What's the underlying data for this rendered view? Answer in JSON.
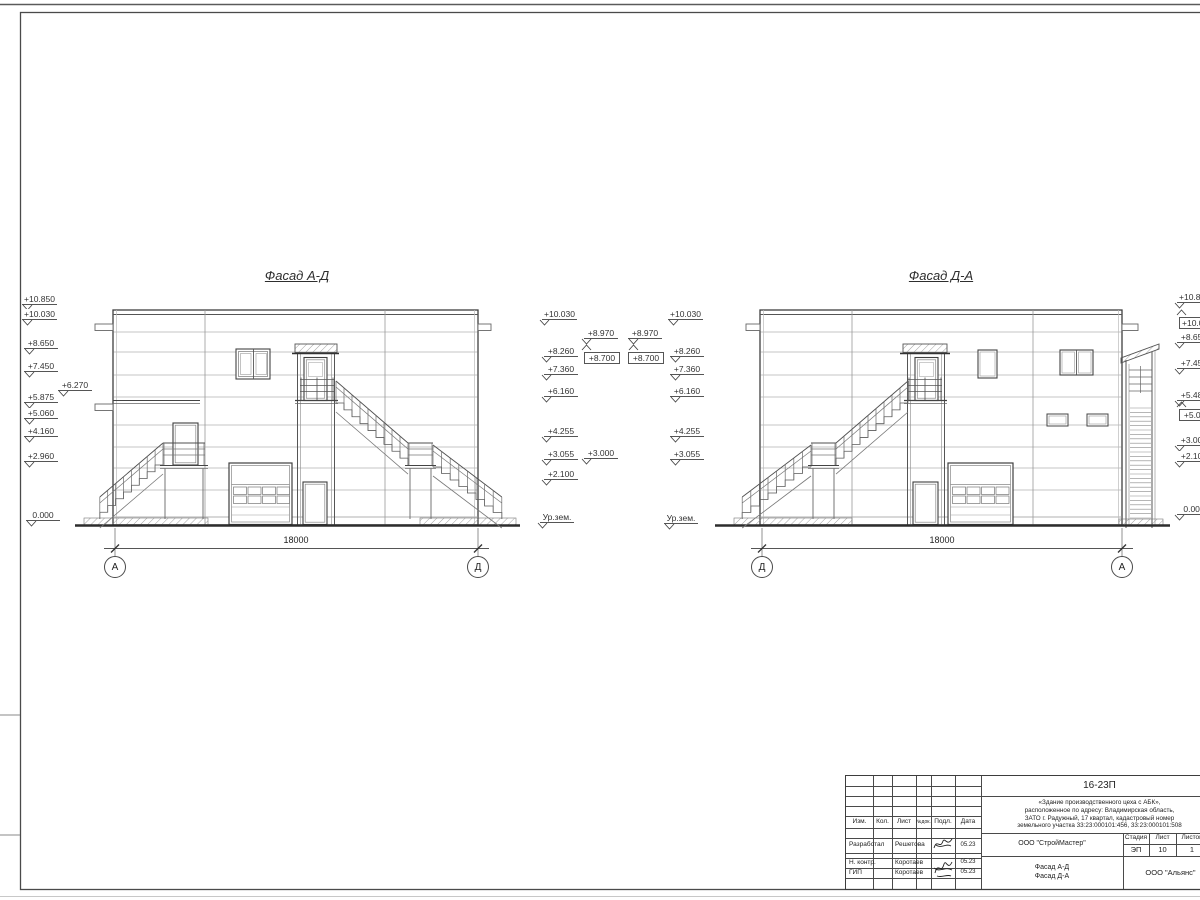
{
  "titles": {
    "facade1": "Фасад А-Д",
    "facade2": "Фасад Д-А"
  },
  "dimensions": [
    {
      "t": "18000",
      "cx": 296,
      "y": 535
    },
    {
      "t": "18000",
      "cx": 942,
      "y": 535
    }
  ],
  "axes": [
    {
      "t": "А",
      "cx": 115,
      "cy": 567
    },
    {
      "t": "Д",
      "cx": 478,
      "cy": 567
    },
    {
      "t": "Д",
      "cx": 762,
      "cy": 567
    },
    {
      "t": "А",
      "cx": 1122,
      "cy": 567
    }
  ],
  "elevation_marks": [
    {
      "t": "+10.850",
      "x": 22,
      "y": 294,
      "s": "r"
    },
    {
      "t": "+10.030",
      "x": 22,
      "y": 309,
      "s": "r"
    },
    {
      "t": "+8.650",
      "x": 24,
      "y": 338,
      "s": "r"
    },
    {
      "t": "+7.450",
      "x": 24,
      "y": 361,
      "s": "r"
    },
    {
      "t": "+6.270",
      "x": 58,
      "y": 380,
      "s": "r"
    },
    {
      "t": "+5.875",
      "x": 24,
      "y": 392,
      "s": "r"
    },
    {
      "t": "+5.060",
      "x": 24,
      "y": 408,
      "s": "r"
    },
    {
      "t": "+4.160",
      "x": 24,
      "y": 426,
      "s": "r"
    },
    {
      "t": "+2.960",
      "x": 24,
      "y": 451,
      "s": "r"
    },
    {
      "t": "0.000",
      "x": 26,
      "y": 510,
      "s": "r"
    },
    {
      "t": "+10.030",
      "x": 542,
      "y": 309,
      "s": "l"
    },
    {
      "t": "+8.260",
      "x": 544,
      "y": 346,
      "s": "l"
    },
    {
      "t": "+7.360",
      "x": 544,
      "y": 364,
      "s": "l"
    },
    {
      "t": "+6.160",
      "x": 544,
      "y": 386,
      "s": "l"
    },
    {
      "t": "+4.255",
      "x": 544,
      "y": 426,
      "s": "l"
    },
    {
      "t": "+3.055",
      "x": 544,
      "y": 449,
      "s": "l"
    },
    {
      "t": "+2.100",
      "x": 544,
      "y": 469,
      "s": "l"
    },
    {
      "t": "Ур.зем.",
      "x": 540,
      "y": 512,
      "s": "l"
    },
    {
      "t": "+8.970",
      "x": 584,
      "y": 328,
      "s": "l"
    },
    {
      "t": "+8.700",
      "x": 584,
      "y": 352,
      "s": "l",
      "boxed": true,
      "up": true
    },
    {
      "t": "+8.970",
      "x": 628,
      "y": 328,
      "s": "r"
    },
    {
      "t": "+8.700",
      "x": 628,
      "y": 352,
      "s": "r",
      "boxed": true,
      "up": true
    },
    {
      "t": "+3.000",
      "x": 584,
      "y": 448,
      "s": "l"
    },
    {
      "t": "+10.030",
      "x": 668,
      "y": 309,
      "s": "r"
    },
    {
      "t": "+8.260",
      "x": 670,
      "y": 346,
      "s": "r"
    },
    {
      "t": "+7.360",
      "x": 670,
      "y": 364,
      "s": "r"
    },
    {
      "t": "+6.160",
      "x": 670,
      "y": 386,
      "s": "r"
    },
    {
      "t": "+4.255",
      "x": 670,
      "y": 426,
      "s": "r"
    },
    {
      "t": "+3.055",
      "x": 670,
      "y": 449,
      "s": "r"
    },
    {
      "t": "Ур.зем.",
      "x": 664,
      "y": 513,
      "s": "r"
    },
    {
      "t": "+10.850",
      "x": 1177,
      "y": 292,
      "s": "l"
    },
    {
      "t": "+10.030",
      "x": 1179,
      "y": 317,
      "s": "l",
      "boxed": true,
      "up": true
    },
    {
      "t": "+8.650",
      "x": 1177,
      "y": 332,
      "s": "l"
    },
    {
      "t": "+7.450",
      "x": 1177,
      "y": 358,
      "s": "l"
    },
    {
      "t": "+5.485",
      "x": 1177,
      "y": 390,
      "s": "l"
    },
    {
      "t": "+5.080",
      "x": 1179,
      "y": 409,
      "s": "l",
      "boxed": true,
      "up": true
    },
    {
      "t": "+3.000",
      "x": 1177,
      "y": 435,
      "s": "l"
    },
    {
      "t": "+2.100",
      "x": 1177,
      "y": 451,
      "s": "l"
    },
    {
      "t": "0.000",
      "x": 1177,
      "y": 504,
      "s": "l"
    }
  ],
  "titleblock": {
    "doc": "16-23П",
    "address_lines": [
      "«Здание производственного цеха с АБК»,",
      "расположенное по адресу: Владимирская область,",
      "ЗАТО г. Радужный, 17 квартал, кадастровый номер",
      "земельного участка 33:23:000101:456, 33:23:000101:508"
    ],
    "cols": [
      "Изм.",
      "Кол.",
      "Лист",
      "№док.",
      "Подл.",
      "Дата"
    ],
    "rows": [
      {
        "role": "Разработал",
        "name": "Решетова",
        "date": "05.23"
      },
      {
        "role": "Н. контр.",
        "name": "Коротаев",
        "date": "05.23"
      },
      {
        "role": "ГИП",
        "name": "Коротаев",
        "date": "05.23"
      }
    ],
    "org": "ООО \"СтройМастер\"",
    "stage_h": "Стадия",
    "sheet_h": "Лист",
    "total_h": "Листов",
    "stage": "ЭП",
    "sheet": "10",
    "total": "1",
    "drawing_title_1": "Фасад А-Д",
    "drawing_title_2": "Фасад Д-А",
    "org2": "ООО \"Альянс\"",
    "colors": {
      "line": "#4a4a4a",
      "light_line": "#a8a8a8",
      "heavy_line": "#2d2d2d",
      "paper": "#ffffff"
    }
  }
}
